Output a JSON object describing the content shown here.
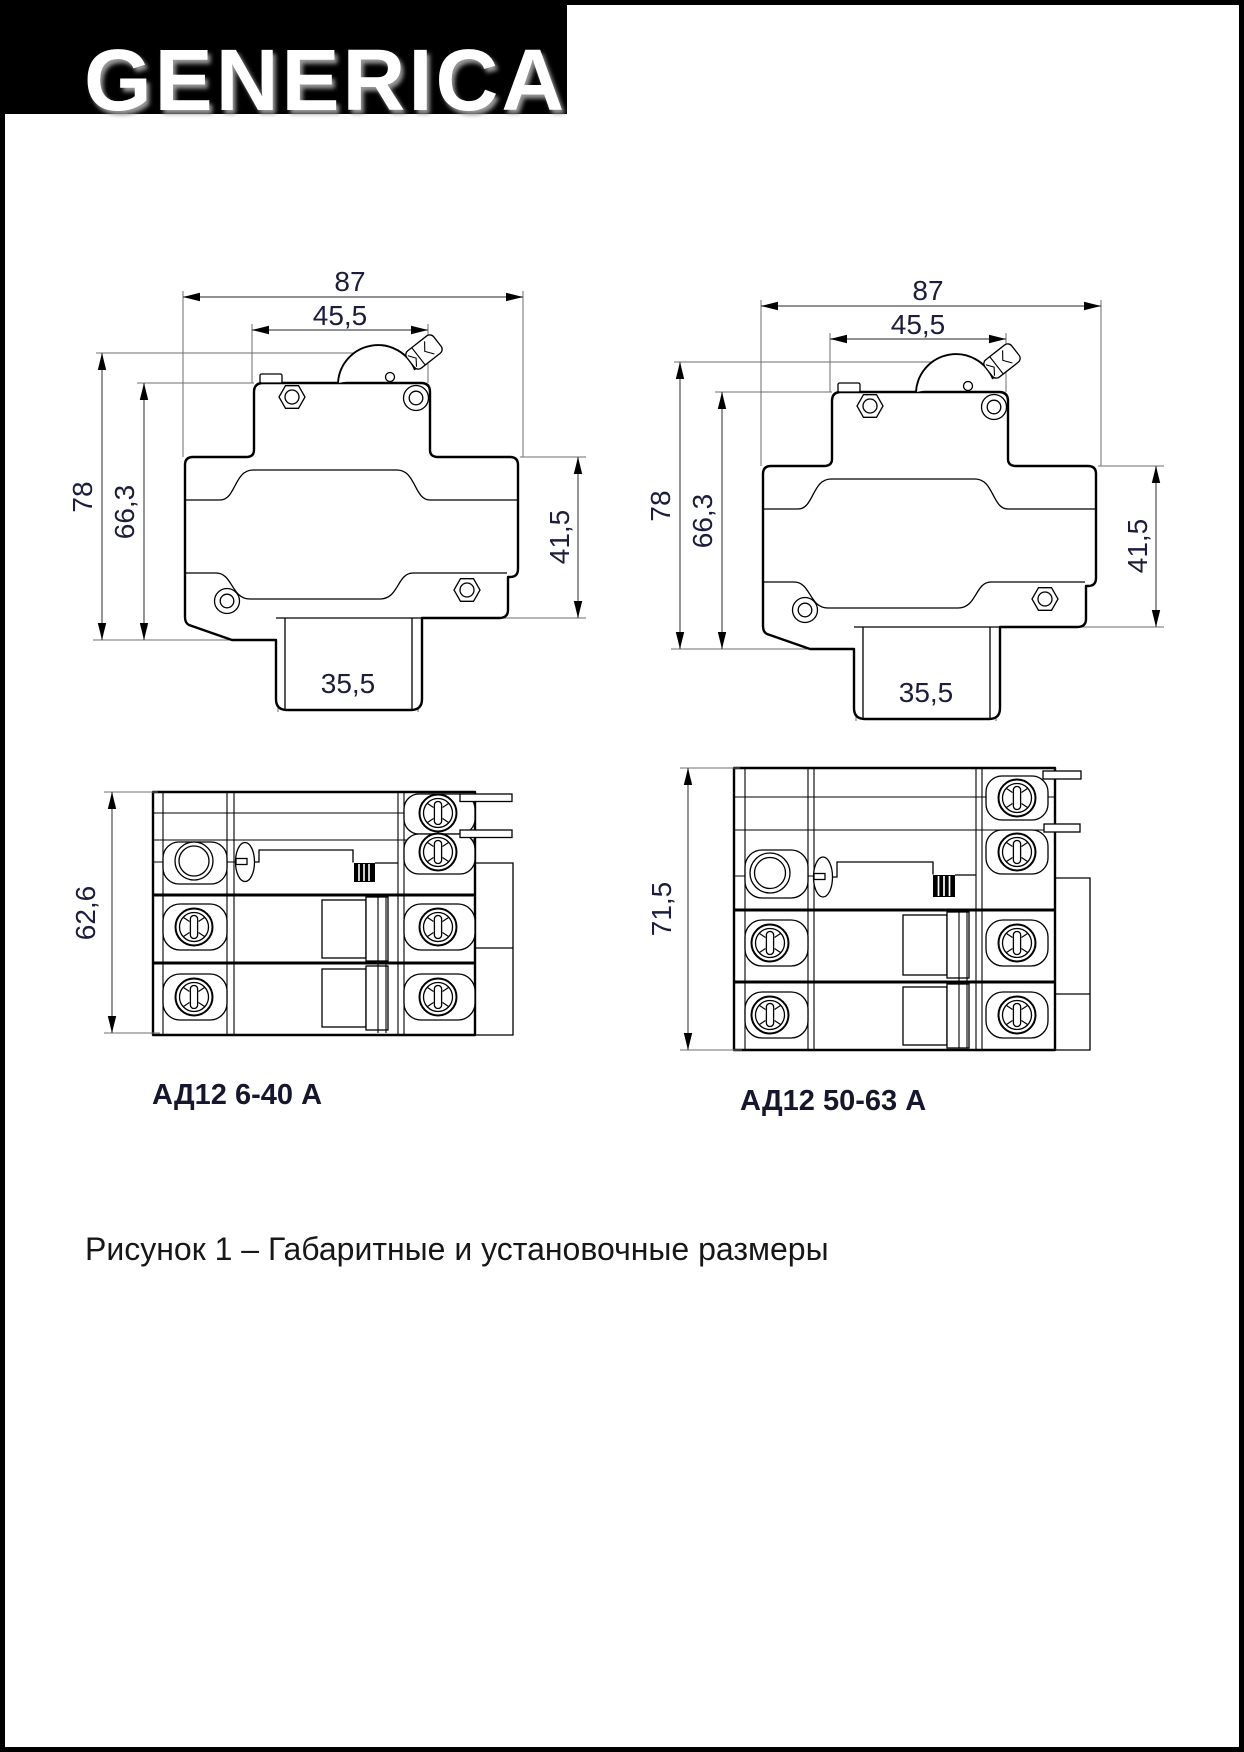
{
  "brand": {
    "logo_text": "GENERICA"
  },
  "figure": {
    "caption": "Рисунок 1 – Габаритные и установочные размеры"
  },
  "side_dims": {
    "overall_width": "87",
    "upper_body_width": "45,5",
    "overall_height": "78",
    "body_height": "66,3",
    "lower_body_height": "41,5",
    "din_recess_width": "35,5"
  },
  "front_left": {
    "label": "АД12 6-40 А",
    "height": "62,6"
  },
  "front_right": {
    "label": "АД12 50-63 А",
    "height": "71,5"
  },
  "colors": {
    "outline": "#000000",
    "dimension_line": "#4f4f4f",
    "dimension_text": "#1c1c3c",
    "brand_background": "#000000",
    "brand_text": "#ffffff"
  }
}
